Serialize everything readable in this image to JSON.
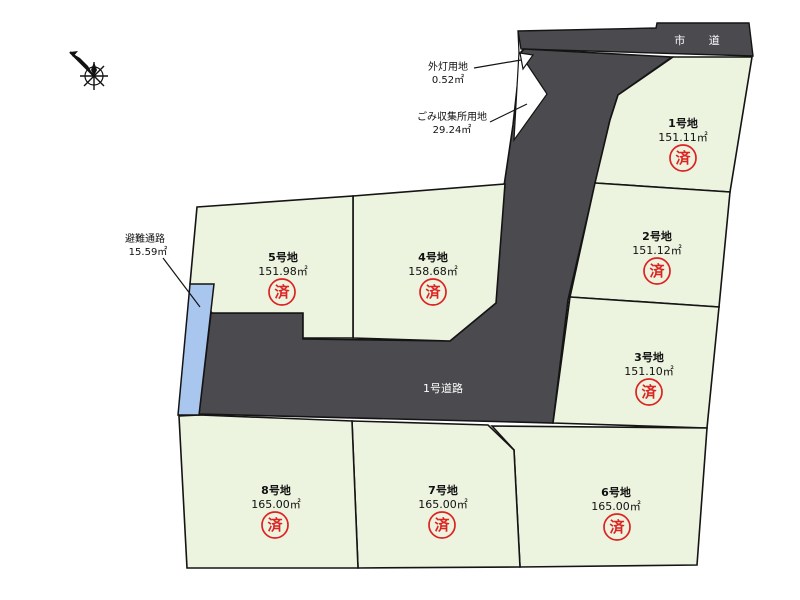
{
  "roads": {
    "city_road": "市 道",
    "road_1": "1号道路"
  },
  "plots": [
    {
      "name": "1号地",
      "area": "151.11㎡",
      "status": "済"
    },
    {
      "name": "2号地",
      "area": "151.12㎡",
      "status": "済"
    },
    {
      "name": "3号地",
      "area": "151.10㎡",
      "status": "済"
    },
    {
      "name": "4号地",
      "area": "158.68㎡",
      "status": "済"
    },
    {
      "name": "5号地",
      "area": "151.98㎡",
      "status": "済"
    },
    {
      "name": "6号地",
      "area": "165.00㎡",
      "status": "済"
    },
    {
      "name": "7号地",
      "area": "165.00㎡",
      "status": "済"
    },
    {
      "name": "8号地",
      "area": "165.00㎡",
      "status": "済"
    }
  ],
  "annotations": {
    "street_light": {
      "label": "外灯用地",
      "area": "0.52㎡"
    },
    "garbage_station": {
      "label": "ごみ収集所用地",
      "area": "29.24㎡"
    },
    "evacuation_path": {
      "label": "避難通路",
      "area": "15.59㎡"
    }
  },
  "colors": {
    "plot_fill": "#ecf3de",
    "road_fill": "#4a4a4f",
    "evacuation_fill": "#a9c6ef",
    "sold_red": "#dd2222"
  }
}
